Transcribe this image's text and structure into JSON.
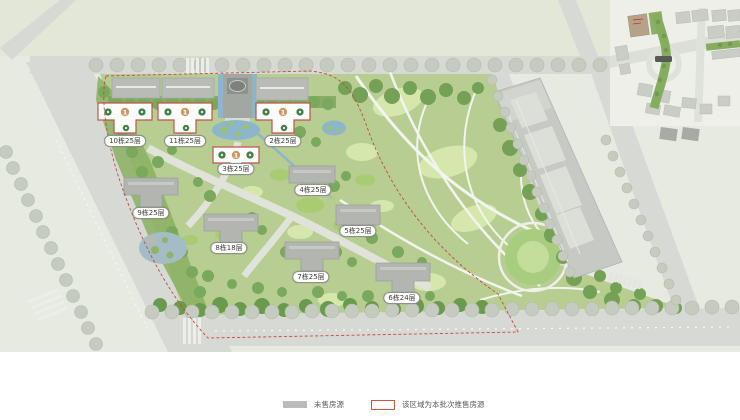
{
  "site_plan": {
    "buildings": [
      {
        "label": "10栋25层",
        "status": "for_sale"
      },
      {
        "label": "11栋25层",
        "status": "for_sale"
      },
      {
        "label": "2栋25层",
        "status": "for_sale"
      },
      {
        "label": "3栋25层",
        "status": "for_sale"
      },
      {
        "label": "4栋25层",
        "status": "unsold"
      },
      {
        "label": "5栋25层",
        "status": "unsold"
      },
      {
        "label": "6栋24层",
        "status": "unsold"
      },
      {
        "label": "7栋25层",
        "status": "unsold"
      },
      {
        "label": "8栋18层",
        "status": "unsold"
      },
      {
        "label": "9栋25层",
        "status": "unsold"
      }
    ],
    "unit_marker": "1",
    "colors": {
      "for_sale_outline": "#c0564a",
      "unsold_building": "#b3b6b0",
      "batch_boundary": "#c44b3f",
      "water": "#8cb6cb",
      "greenery": "#74a156",
      "road": "#d7d9d5"
    }
  },
  "legend": {
    "unsold": {
      "label": "未售房源",
      "swatch_color": "#b9bcb8"
    },
    "batch": {
      "label": "该区域为本批次推售房源",
      "outline_color": "#c7584b"
    }
  }
}
